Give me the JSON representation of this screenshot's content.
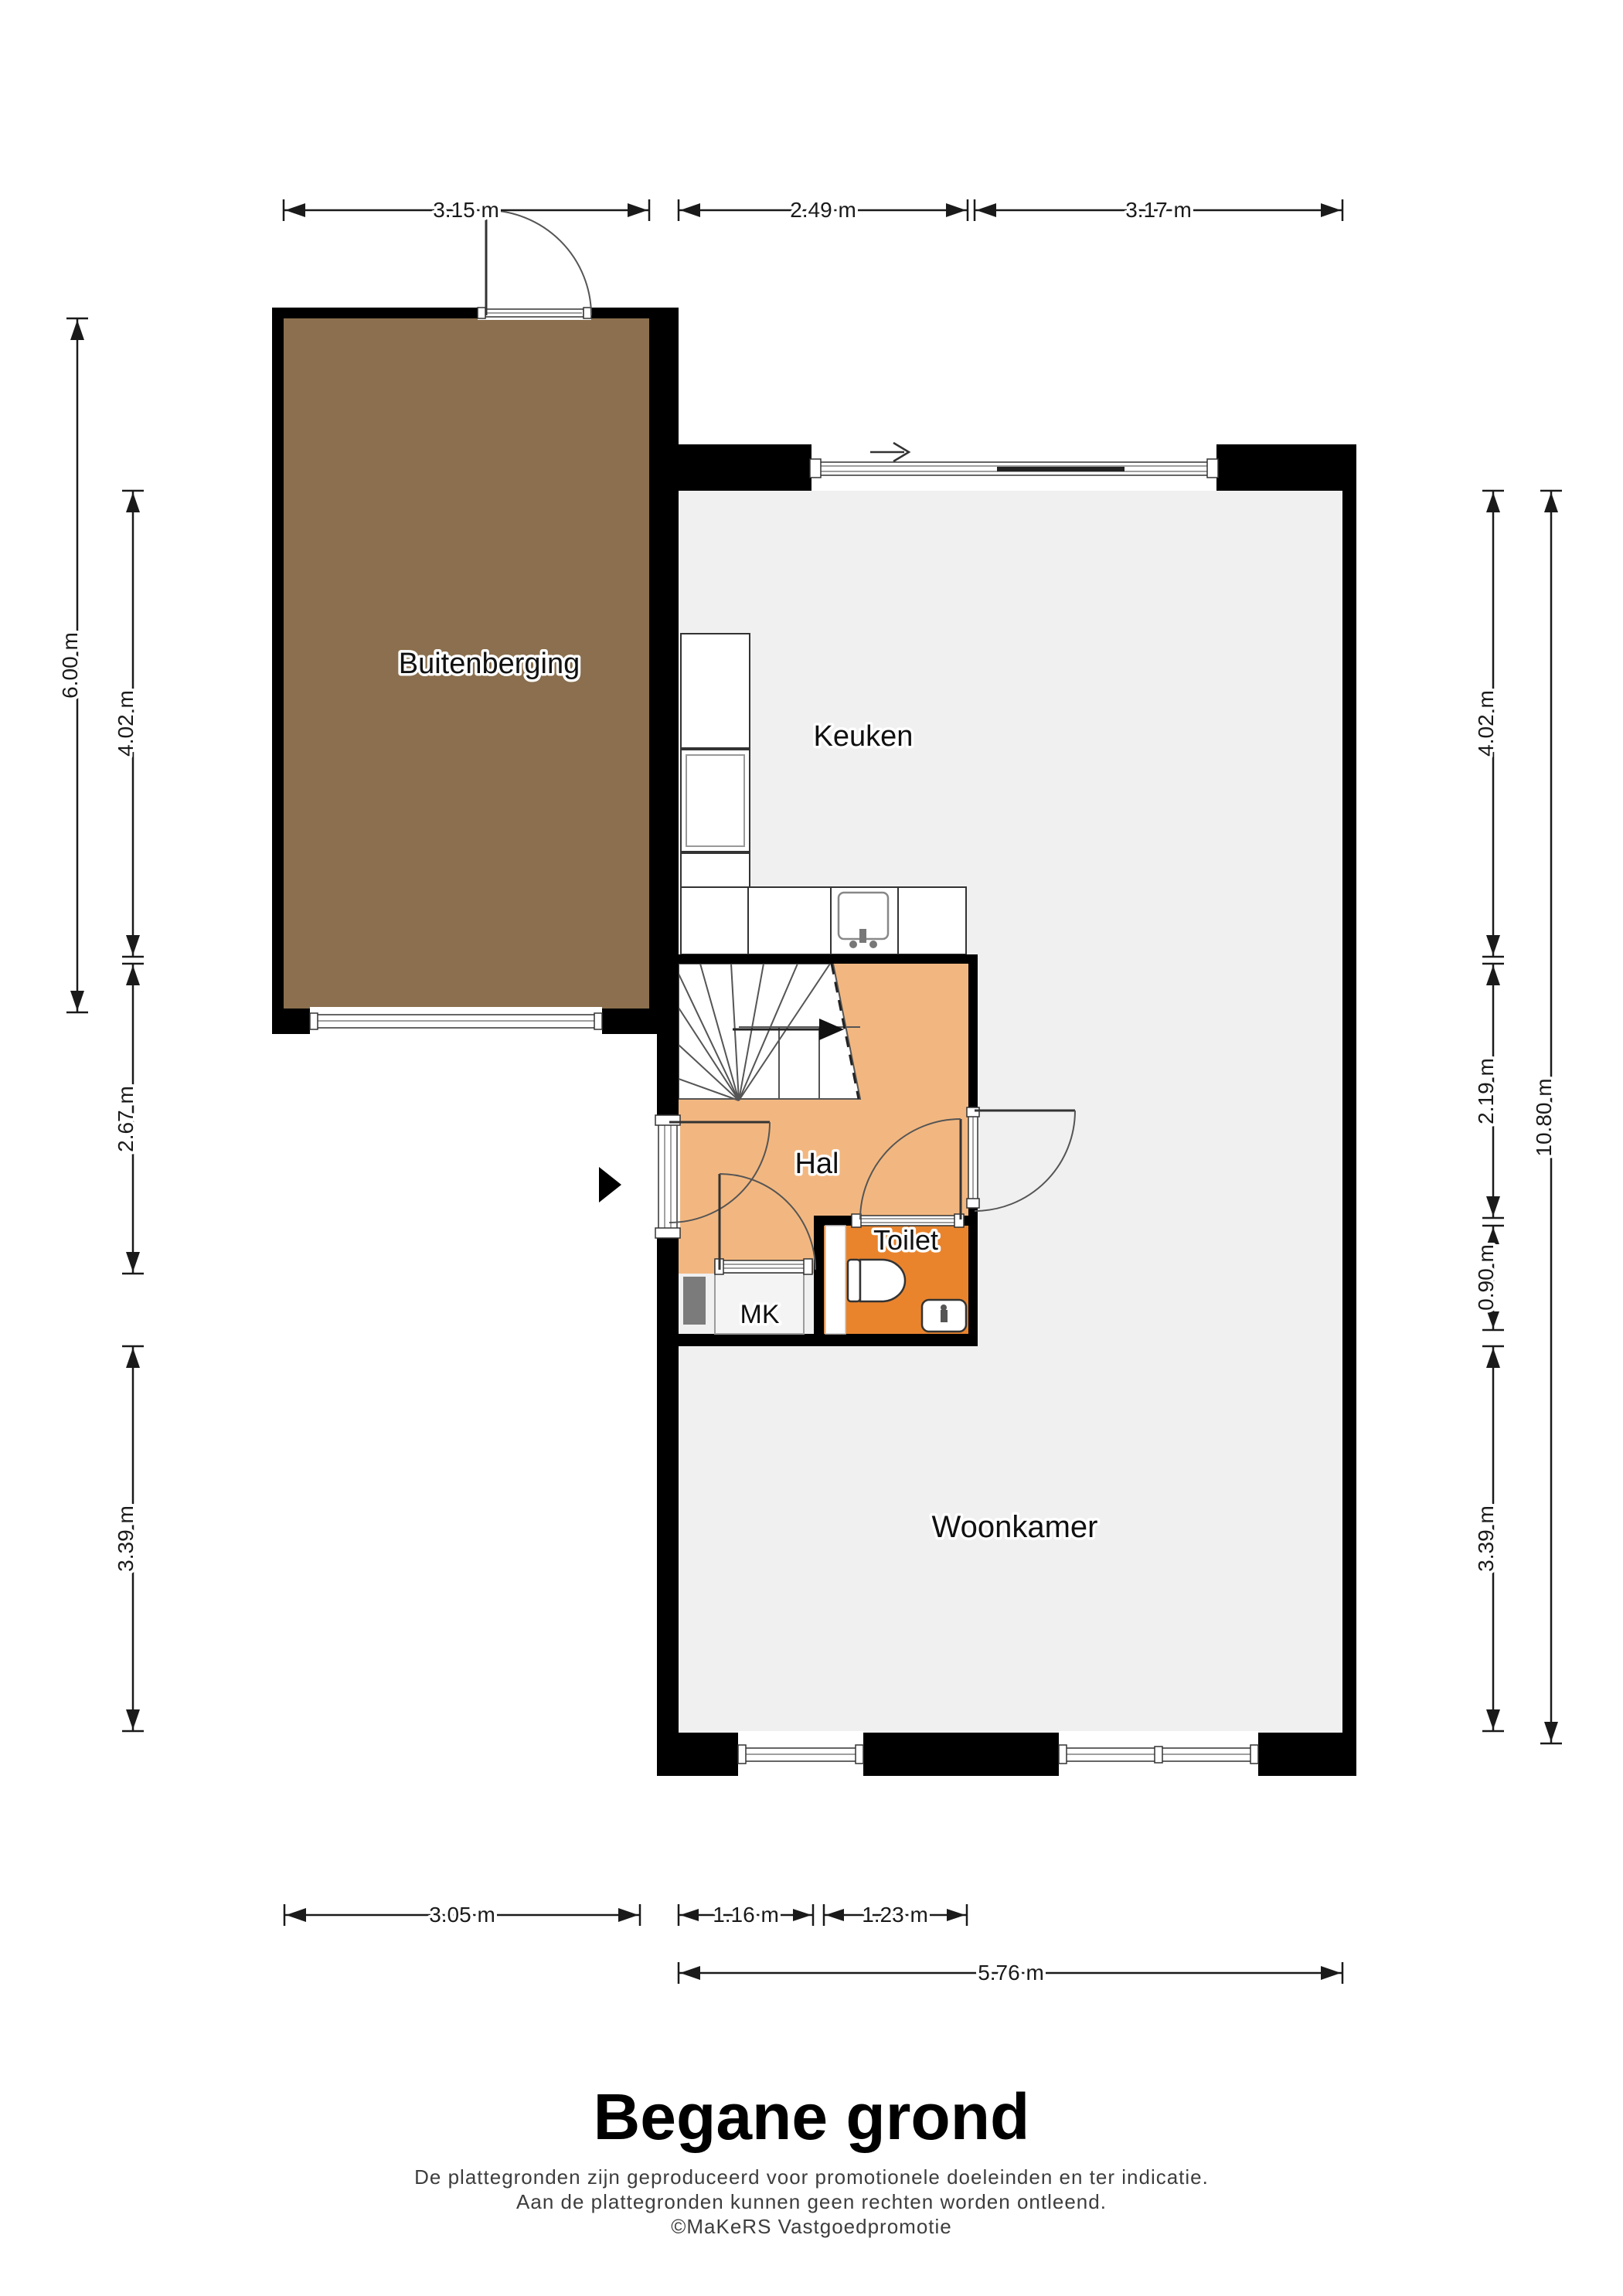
{
  "floorplan": {
    "name": "Begane grond plattegrond",
    "rooms": {
      "storage": "Buitenberging",
      "kitchen": "Keuken",
      "hall": "Hal",
      "toilet": "Toilet",
      "mk": "MK",
      "living": "Woonkamer"
    },
    "dimensions": {
      "top": [
        "3.15 m",
        "2.49 m",
        "3.17 m"
      ],
      "bottom": [
        "3.05 m",
        "1.16 m",
        "1.23 m",
        "5.76 m"
      ],
      "left": [
        "6.00 m",
        "4.02 m",
        "2.67 m",
        "3.39 m"
      ],
      "right": [
        "4.02 m",
        "2.19 m",
        "0.90 m",
        "3.39 m",
        "10.80 m"
      ]
    },
    "colors": {
      "wall": "#000000",
      "floor": "#f0f0f0",
      "storage": "#8b6f4e",
      "hall": "#f2b780",
      "toilet": "#e9842d",
      "mk_box": "#f4f4f4",
      "dark_cabinet": "#7b7b7b"
    }
  },
  "footer": {
    "title": "Begane grond",
    "disclaimer1": "De plattegronden zijn geproduceerd voor promotionele doeleinden en ter indicatie.",
    "disclaimer2": "Aan de plattegronden kunnen geen rechten worden ontleend.",
    "credit": "©MaKeRS Vastgoedpromotie"
  }
}
